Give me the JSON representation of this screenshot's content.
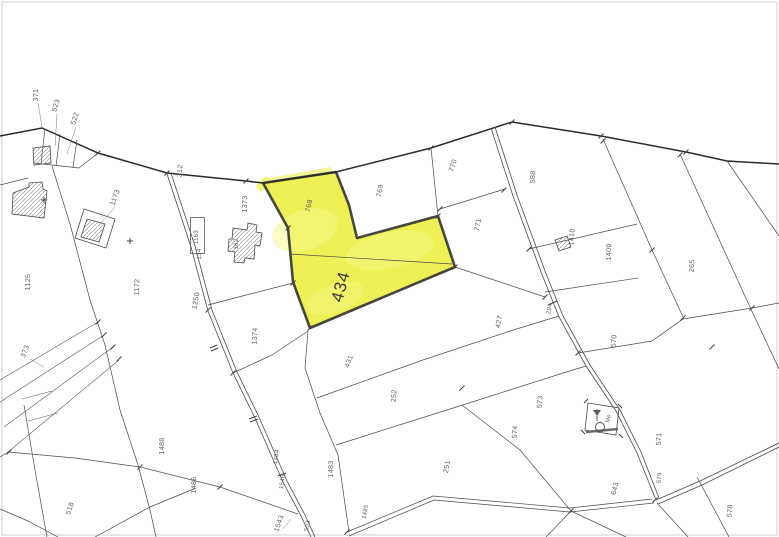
{
  "map": {
    "highlighted_parcel": {
      "number": "434",
      "fill": "#ebf046",
      "outline": "#333333"
    },
    "colors": {
      "background": "#ffffff",
      "line": "#4a4a4a",
      "label": "#5a5a5a"
    },
    "parcel_labels": {
      "p371": "371",
      "p523": "523",
      "p522": "522",
      "p1125": "1125",
      "p1173": "1173",
      "p1172": "1172",
      "p312": "312",
      "p1163": "1163",
      "p134": "134",
      "p1373": "1373",
      "p162": "162",
      "p1250": "1250",
      "p373": "373",
      "p768": "768",
      "p769": "769",
      "p770": "770",
      "p771": "771",
      "p588": "588",
      "p1410": "1410",
      "p1409": "1409",
      "p265": "265",
      "p294": "294",
      "p427": "427",
      "p1374": "1374",
      "p431": "431",
      "p252": "252",
      "p573": "573",
      "p574": "574",
      "p570": "570",
      "p571": "571",
      "p579": "579",
      "p643": "643",
      "p578": "578",
      "p251": "251",
      "p1483": "1483",
      "p1484": "1484",
      "p1546": "1546",
      "p1543": "1543",
      "p1485": "1485",
      "p503": "503",
      "p1486": "1486",
      "p1488": "1488",
      "p518": "518",
      "pM6": "M6"
    }
  }
}
